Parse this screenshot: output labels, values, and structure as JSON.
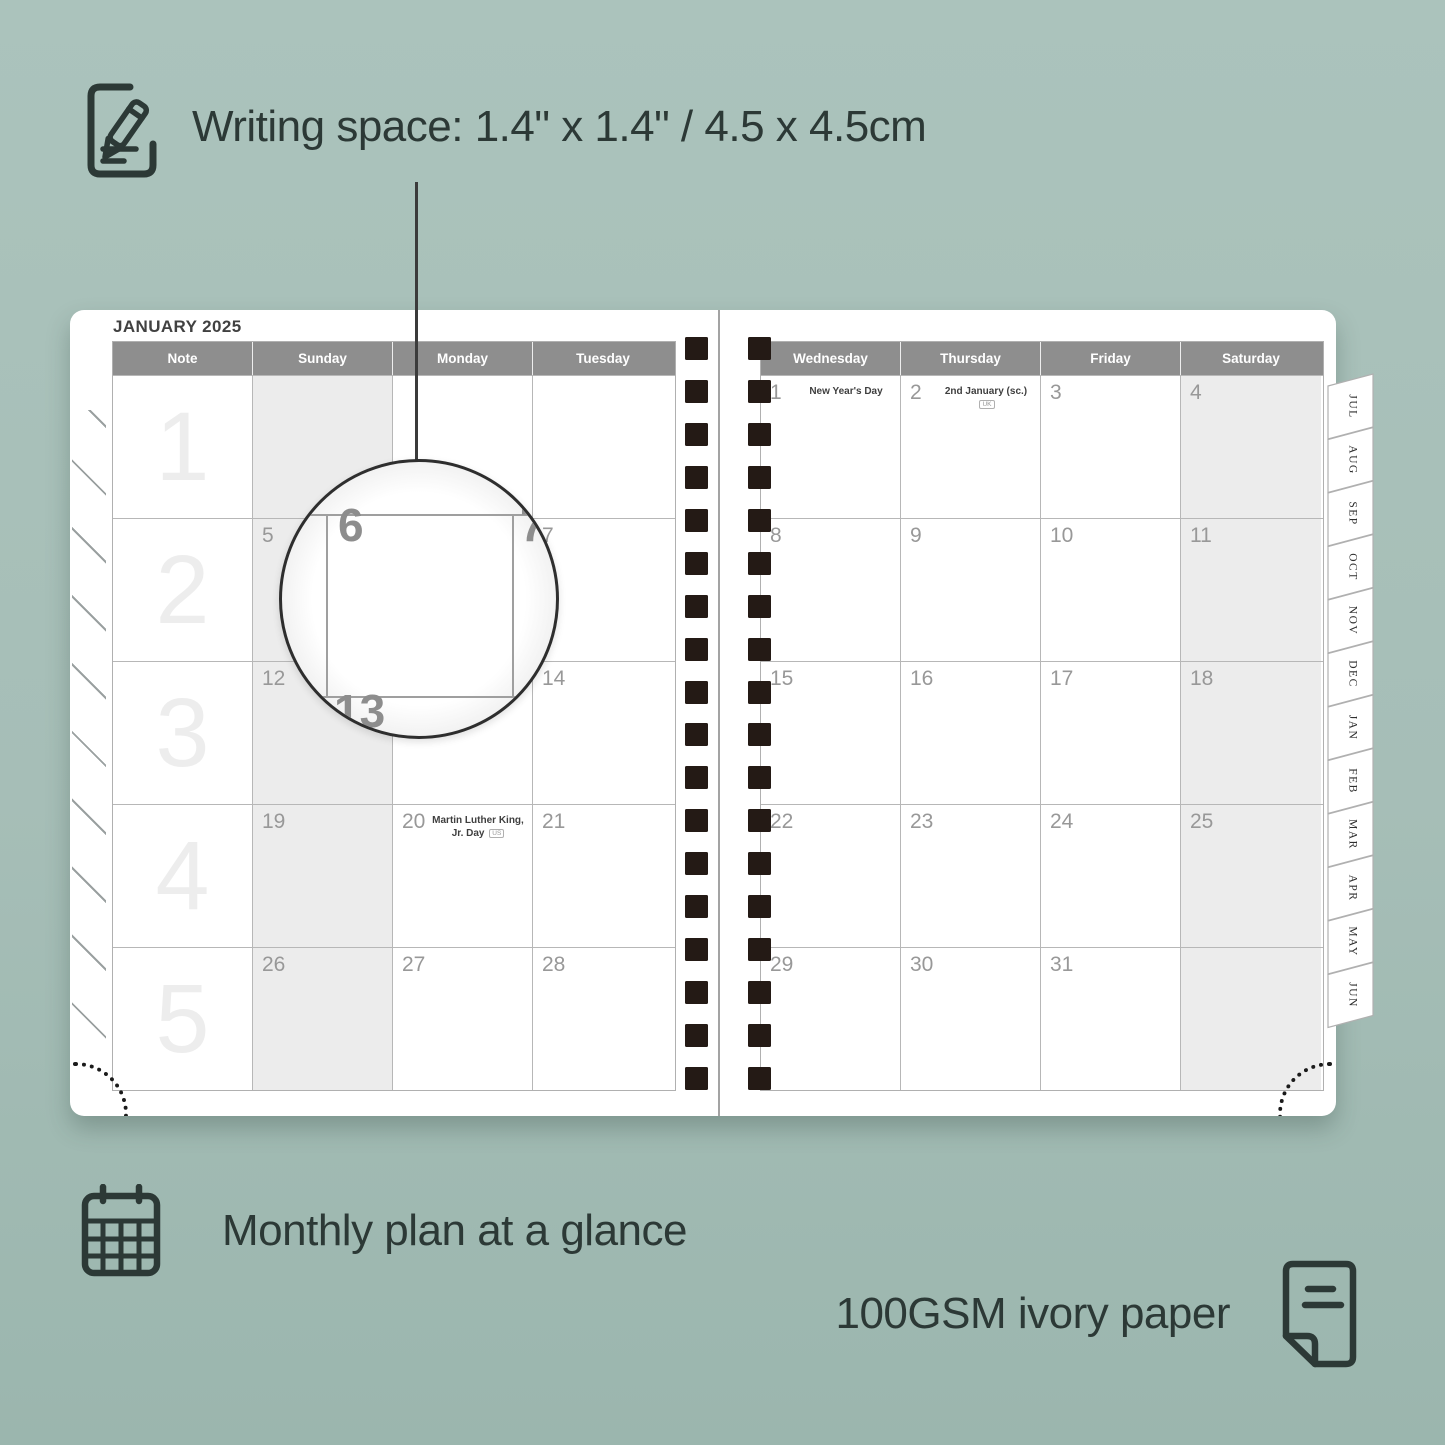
{
  "annotations": {
    "writing_space": {
      "icon": "pencil-note-icon",
      "text": "Writing space: 1.4\" x 1.4\" / 4.5 x 4.5cm"
    },
    "monthly_plan": {
      "icon": "calendar-grid-icon",
      "text": "Monthly plan at a glance"
    },
    "paper": {
      "icon": "paper-sheet-icon",
      "text": "100GSM ivory paper"
    }
  },
  "planner": {
    "left_page": {
      "title": "JANUARY 2025",
      "columns": [
        "Note",
        "Sunday",
        "Monday",
        "Tuesday"
      ],
      "shaded_column_index": 1,
      "weeks": [
        {
          "label": "1",
          "cells": [
            {},
            {},
            {},
            {}
          ]
        },
        {
          "label": "2",
          "cells": [
            {},
            {
              "date": "5"
            },
            {
              "date": "6"
            },
            {
              "date": "7"
            }
          ]
        },
        {
          "label": "3",
          "cells": [
            {},
            {
              "date": "12"
            },
            {
              "date": "13"
            },
            {
              "date": "14"
            }
          ]
        },
        {
          "label": "4",
          "cells": [
            {},
            {
              "date": "19"
            },
            {
              "date": "20",
              "holiday": "Martin Luther King, Jr. Day",
              "badge": "US"
            },
            {
              "date": "21"
            }
          ]
        },
        {
          "label": "5",
          "cells": [
            {},
            {
              "date": "26"
            },
            {
              "date": "27"
            },
            {
              "date": "28"
            }
          ]
        }
      ]
    },
    "right_page": {
      "columns": [
        "Wednesday",
        "Thursday",
        "Friday",
        "Saturday"
      ],
      "shaded_column_index": 3,
      "weeks": [
        {
          "cells": [
            {
              "date": "1",
              "holiday": "New Year's Day"
            },
            {
              "date": "2",
              "holiday": "2nd January (sc.)",
              "badge": "UK"
            },
            {
              "date": "3"
            },
            {
              "date": "4"
            }
          ]
        },
        {
          "cells": [
            {
              "date": "8"
            },
            {
              "date": "9"
            },
            {
              "date": "10"
            },
            {
              "date": "11"
            }
          ]
        },
        {
          "cells": [
            {
              "date": "15"
            },
            {
              "date": "16"
            },
            {
              "date": "17"
            },
            {
              "date": "18"
            }
          ]
        },
        {
          "cells": [
            {
              "date": "22"
            },
            {
              "date": "23"
            },
            {
              "date": "24"
            },
            {
              "date": "25"
            }
          ]
        },
        {
          "cells": [
            {
              "date": "29"
            },
            {
              "date": "30"
            },
            {
              "date": "31"
            },
            {}
          ]
        }
      ]
    },
    "month_tabs": [
      "JUL",
      "AUG",
      "SEP",
      "OCT",
      "NOV",
      "DEC",
      "JAN",
      "FEB",
      "MAR",
      "APR",
      "MAY",
      "JUN"
    ],
    "magnifier": {
      "cell_date": "6",
      "adjacent_date": "7",
      "below_date": "13"
    },
    "binding_holes_per_column": 18
  },
  "colors": {
    "background": "#a7c0b8",
    "page": "#ffffff",
    "header_bar": "#8e8e8e",
    "shaded_cell": "#ececec",
    "binding_hole": "#241a15",
    "annotation_text": "#2c3936"
  }
}
